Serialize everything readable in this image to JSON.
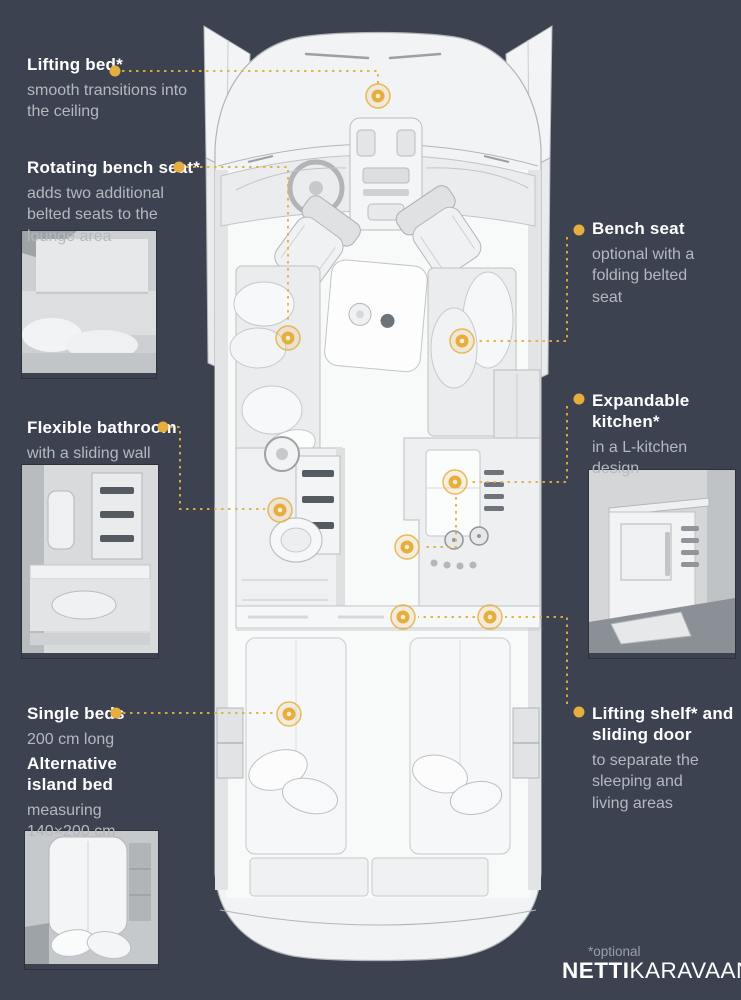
{
  "background": "#3C4250",
  "accent": "#E6AE3E",
  "marker_core": "#F8EECD",
  "callouts": [
    {
      "id": "lifting-bed",
      "title": "Lifting bed*",
      "body": "smooth transitions into the ceiling",
      "side": "left",
      "text_pos": [
        27,
        54
      ],
      "width": 170,
      "dot": [
        115,
        71
      ],
      "lines": [
        [
          [
            122,
            71
          ],
          [
            378,
            71
          ],
          [
            378,
            87
          ]
        ]
      ],
      "markers": [
        [
          378,
          96
        ]
      ]
    },
    {
      "id": "rotating-bench-seat",
      "title": "Rotating bench seat*",
      "body": "adds two additional belted seats to the lounge area",
      "side": "left",
      "text_pos": [
        27,
        157
      ],
      "width": 190,
      "dot": [
        179,
        167
      ],
      "lines": [
        [
          [
            186,
            167
          ],
          [
            288,
            167
          ],
          [
            288,
            324
          ]
        ]
      ],
      "markers": [
        [
          288,
          338
        ]
      ]
    },
    {
      "id": "flexible-bathroom",
      "title": "Flexible bathroom",
      "body": "with a sliding wall",
      "side": "left",
      "text_pos": [
        27,
        417
      ],
      "width": 170,
      "dot": [
        163,
        427
      ],
      "lines": [
        [
          [
            170,
            427
          ],
          [
            180,
            427
          ],
          [
            180,
            509
          ],
          [
            265,
            509
          ]
        ]
      ],
      "markers": [
        [
          280,
          510
        ]
      ]
    },
    {
      "id": "single-beds",
      "title": "Single beds",
      "body": "200 cm long",
      "side": "left",
      "text_pos": [
        27,
        703
      ],
      "width": 160,
      "dot": [
        116,
        713
      ],
      "lines": [
        [
          [
            123,
            713
          ],
          [
            274,
            713
          ]
        ]
      ],
      "markers": [
        [
          289,
          714
        ]
      ]
    },
    {
      "id": "alternative-island-bed",
      "title": "Alternative island bed",
      "body": "measuring 140×200 cm",
      "side": "left",
      "text_pos": [
        27,
        753
      ],
      "width": 122,
      "dot": null,
      "lines": [],
      "markers": []
    },
    {
      "id": "bench-seat",
      "title": "Bench seat",
      "body": "optional with a folding belted seat",
      "side": "right",
      "text_pos": [
        592,
        218
      ],
      "width": 118,
      "dot": [
        579,
        230
      ],
      "lines": [
        [
          [
            567,
            237
          ],
          [
            567,
            341
          ],
          [
            478,
            341
          ]
        ]
      ],
      "markers": [
        [
          462,
          341
        ]
      ]
    },
    {
      "id": "expandable-kitchen",
      "title": "Expandable kitchen*",
      "body": "in a L-kitchen design",
      "side": "right",
      "text_pos": [
        592,
        390
      ],
      "width": 122,
      "dot": [
        579,
        399
      ],
      "lines": [
        [
          [
            567,
            406
          ],
          [
            567,
            482
          ],
          [
            471,
            482
          ]
        ],
        [
          [
            456,
            497
          ],
          [
            456,
            547
          ],
          [
            422,
            547
          ]
        ]
      ],
      "markers": [
        [
          455,
          482
        ],
        [
          407,
          547
        ]
      ]
    },
    {
      "id": "lifting-shelf",
      "title": "Lifting shelf* and sliding door",
      "body": "to separate the sleeping and living areas",
      "side": "right",
      "text_pos": [
        592,
        703
      ],
      "width": 148,
      "dot": [
        579,
        712
      ],
      "lines": [
        [
          [
            567,
            704
          ],
          [
            567,
            617
          ],
          [
            505,
            617
          ]
        ],
        [
          [
            475,
            617
          ],
          [
            418,
            617
          ]
        ]
      ],
      "markers": [
        [
          490,
          617
        ],
        [
          403,
          617
        ]
      ]
    }
  ],
  "footer": {
    "optional_note": "*optional",
    "brand_bold": "NETTI",
    "brand_light": "KARAVAANI"
  }
}
